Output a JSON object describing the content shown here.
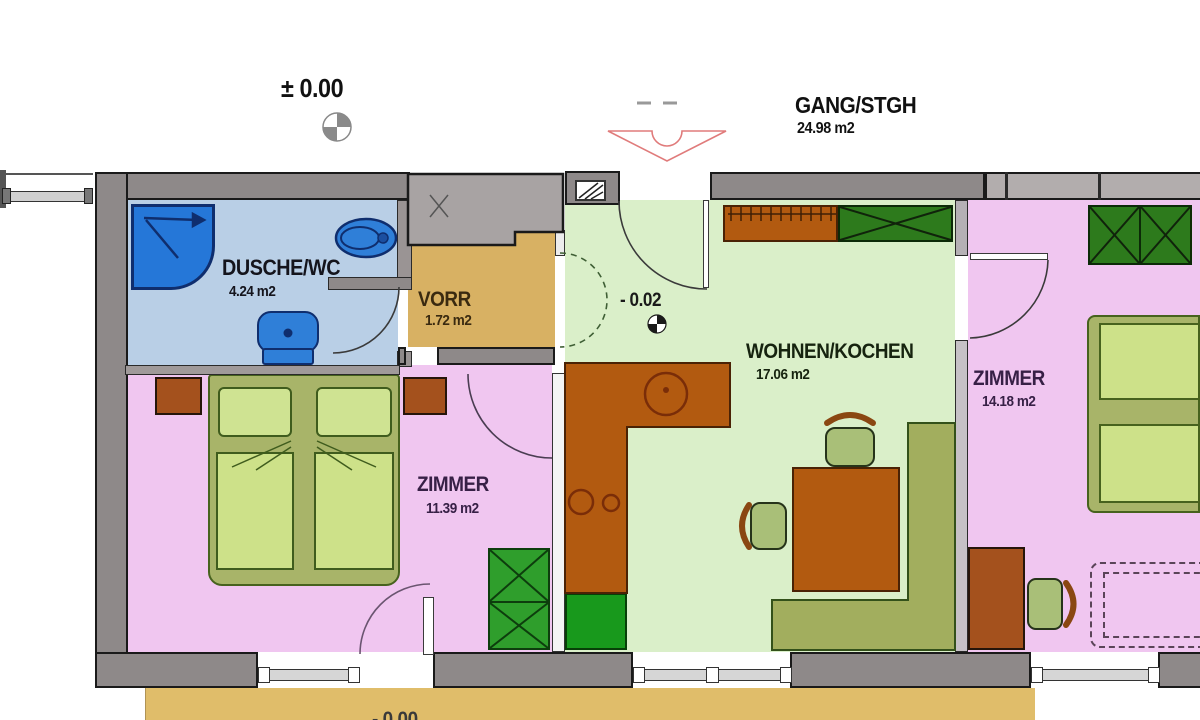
{
  "annotations": {
    "upper_level": "±  0.00",
    "inner_level": "- 0.02",
    "terrace_level": "- 0.00",
    "corridor_name": "GANG/STGH",
    "corridor_area": "24.98 m2"
  },
  "rooms": {
    "bath": {
      "name": "DUSCHE/WC",
      "area": "4.24 m2"
    },
    "vorraum": {
      "name": "VORR",
      "area": "1.72 m2"
    },
    "bedroom1": {
      "name": "ZIMMER",
      "area": "11.39 m2"
    },
    "living": {
      "name": "WOHNEN/KOCHEN",
      "area": "17.06 m2"
    },
    "bedroom2": {
      "name": "ZIMMER",
      "area": "14.18 m2"
    }
  },
  "colors": {
    "wall": "#8e8989",
    "wall_window_band": "#b2adad",
    "floor_bath": "#b9cfe6",
    "floor_vorraum": "#d8b163",
    "floor_living": "#daefc9",
    "floor_bedroom": "#f0c6f0",
    "terrace": "#e0bd6a",
    "fixture_blue": "#2f7fd8",
    "counter_brown": "#b25a10",
    "wardrobe_green": "#2d7a1c",
    "cabinet_green": "#2f9e2c",
    "bench_olive": "#a2ae5e",
    "bed_frame": "#a8b469",
    "bed_duvet": "#cde189",
    "entrance_arrow_outline": "#e07b7b"
  }
}
